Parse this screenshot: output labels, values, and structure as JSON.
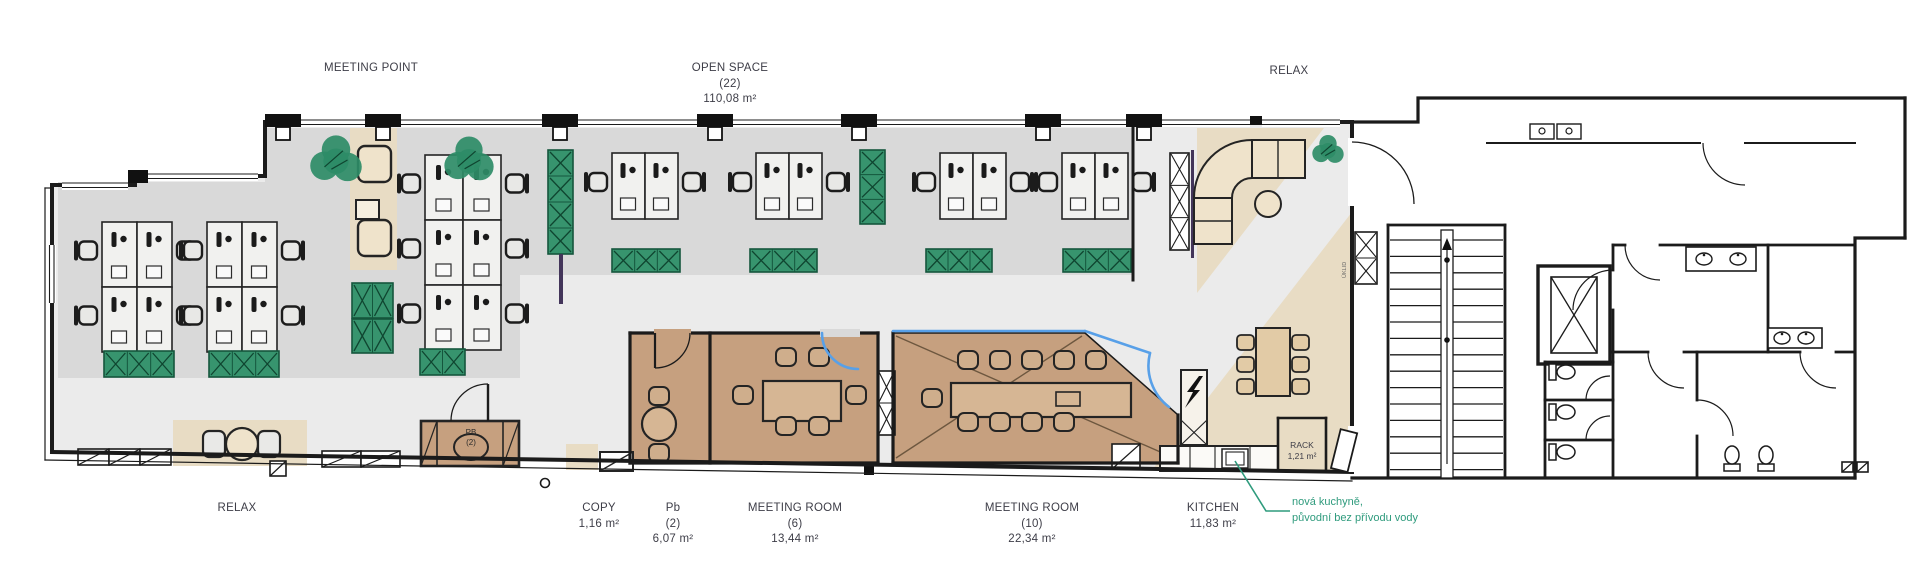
{
  "plan": {
    "areas": {
      "meeting_point": {
        "label": "MEETING POINT"
      },
      "open_space": {
        "label": "OPEN SPACE",
        "capacity": "(22)",
        "area": "110,08 m²"
      },
      "relax_top": {
        "label": "RELAX"
      },
      "relax_bottom": {
        "label": "RELAX"
      },
      "copy": {
        "label": "COPY",
        "area": "1,16 m²"
      },
      "pb_room": {
        "label": "Pb",
        "capacity": "(2)",
        "area": "6,07 m²"
      },
      "meeting_room_6": {
        "label": "MEETING ROOM",
        "capacity": "(6)",
        "area": "13,44 m²"
      },
      "meeting_room_10": {
        "label": "MEETING ROOM",
        "capacity": "(10)",
        "area": "22,34 m²"
      },
      "kitchen": {
        "label": "KITCHEN",
        "area": "11,83 m²"
      },
      "rack": {
        "label": "RACK",
        "area": "1,21 m²"
      },
      "utility_closet": {
        "label": "ÚKLID"
      }
    },
    "furniture_labels": {
      "pb_booth": {
        "label": "PB",
        "capacity": "(2)"
      }
    },
    "annotation": {
      "line1": "nová kuchyně,",
      "line2": "původní bez přívodu vody"
    },
    "colors": {
      "open_space_floor": "#d9d9d9",
      "circulation_floor": "#ebebeb",
      "carpet_tan": "#e8dcc4",
      "meeting_room_brown": "#c6a07f",
      "table_tan": "#d6b694",
      "plant_green": "#37946e",
      "plant_dark": "#0f4530",
      "glazing_blue": "#58a0e8",
      "annotation_green": "#2f9b7d",
      "wall_black": "#1b1b1b",
      "label_text": "#3d3d47"
    }
  }
}
